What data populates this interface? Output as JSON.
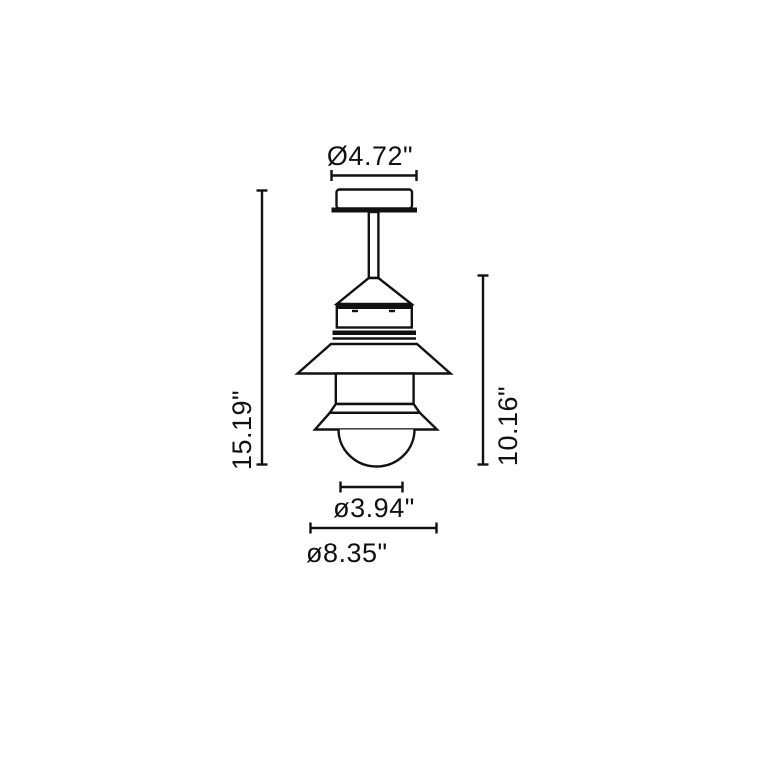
{
  "canvas": {
    "background": "#ffffff",
    "line_color": "#111111"
  },
  "drawing": {
    "labels": {
      "canopy_diameter": "Ø4.72\"",
      "overall_height": "15.19\"",
      "fixture_height": "10.16\"",
      "diffuser_diameter": "ø3.94\"",
      "shade_diameter": "ø8.35\""
    }
  }
}
